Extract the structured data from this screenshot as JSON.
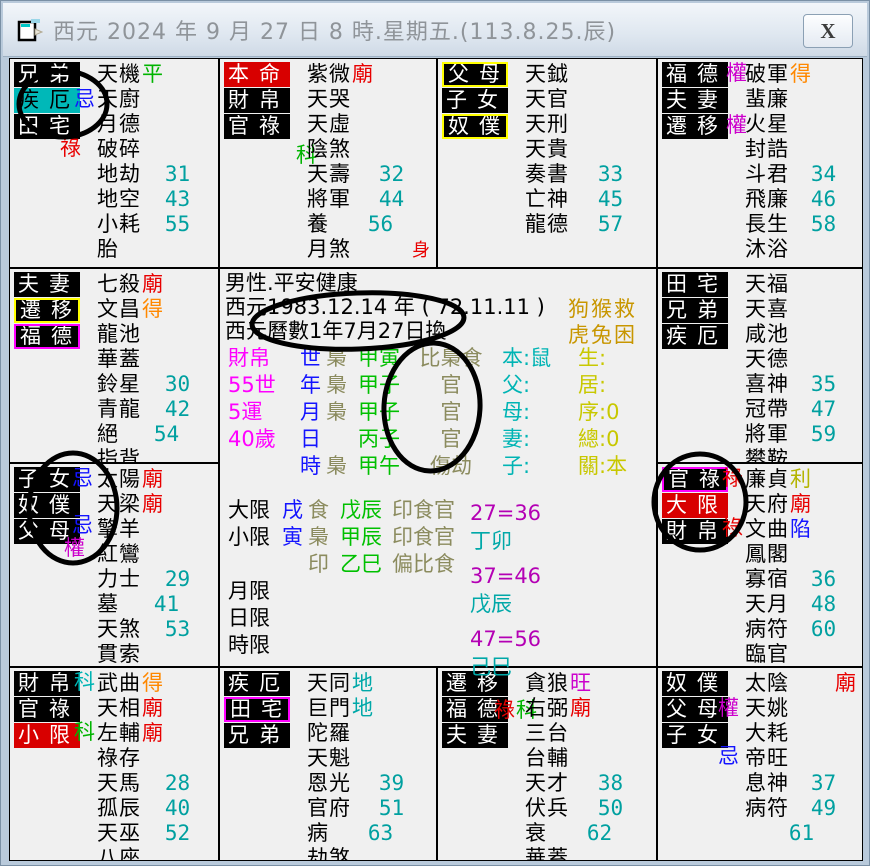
{
  "window": {
    "title": "西元 2024 年 9 月 27 日 8 時.星期五.(113.8.25.辰)",
    "close_label": "X"
  },
  "colors": {
    "transform_lu": "#e80000",
    "transform_quan": "#cc00cc",
    "transform_ke": "#00b400",
    "transform_ke_cyan": "#00b4b4",
    "transform_ji": "#1414ff",
    "bright_miao": "#e80000",
    "bright_de": "#ff8800",
    "bright_ping": "#00b400",
    "bright_wang": "#cc00cc",
    "bright_li": "#b4b400",
    "bright_xian": "#1414ff",
    "bright_di": "#00a8a8",
    "age_number": "#00a0a0",
    "label_black_bg": "#000000",
    "label_red_bg": "#d80000",
    "label_cyan_bg": "#00b8b8",
    "border_yellow": "#ffff00",
    "border_magenta": "#ff00ff"
  },
  "palaces": [
    {
      "branch": "si",
      "labels": [
        {
          "t": "兄弟",
          "s": "k"
        },
        {
          "t": "疾厄",
          "s": "c"
        },
        {
          "t": "田宅",
          "s": "k"
        }
      ],
      "transforms": [
        {
          "t": "忌",
          "c": "#1414ff"
        },
        {
          "t": "祿",
          "c": "#e80000"
        }
      ],
      "stars": [
        {
          "n": "天機",
          "b": "平",
          "bc": "#00b400"
        },
        {
          "n": "天廚"
        },
        {
          "n": "月德"
        },
        {
          "n": "破碎"
        },
        {
          "n": "地劫",
          "a": "31"
        },
        {
          "n": "地空",
          "a": "43"
        },
        {
          "n": "小耗",
          "a": "55"
        },
        {
          "n": "胎"
        }
      ]
    },
    {
      "branch": "wu",
      "labels": [
        {
          "t": "本命",
          "s": "r"
        },
        {
          "t": "財帛",
          "s": "k"
        },
        {
          "t": "官祿",
          "s": "k"
        }
      ],
      "transforms": [
        {
          "t": "科",
          "c": "#00b400"
        }
      ],
      "stars": [
        {
          "n": "紫微",
          "b": "廟",
          "bc": "#e80000"
        },
        {
          "n": "天哭"
        },
        {
          "n": "天虛"
        },
        {
          "n": "陰煞"
        },
        {
          "n": "天壽",
          "a": "32"
        },
        {
          "n": "將軍",
          "a": "44"
        },
        {
          "n": "養",
          "a": "56"
        },
        {
          "n": "月煞",
          "t": "身",
          "tc": "#e80000",
          "tsm": "1"
        }
      ]
    },
    {
      "branch": "wei",
      "labels": [
        {
          "t": "父母",
          "s": "y"
        },
        {
          "t": "子女",
          "s": "k"
        },
        {
          "t": "奴僕",
          "s": "y"
        }
      ],
      "transforms": [],
      "stars": [
        {
          "n": "天鉞"
        },
        {
          "n": "天官"
        },
        {
          "n": "天刑"
        },
        {
          "n": "天貴"
        },
        {
          "n": "奏書",
          "a": "33"
        },
        {
          "n": "亡神",
          "a": "45"
        },
        {
          "n": "龍德",
          "a": "57"
        }
      ]
    },
    {
      "branch": "shen",
      "labels": [
        {
          "t": "福德",
          "s": "k"
        },
        {
          "t": "夫妻",
          "s": "k"
        },
        {
          "t": "遷移",
          "s": "k"
        }
      ],
      "transforms": [
        {
          "t": "權",
          "c": "#cc00cc"
        },
        {
          "t": "權",
          "c": "#cc00cc"
        }
      ],
      "stars": [
        {
          "n": "破軍",
          "b": "得",
          "bc": "#ff8800"
        },
        {
          "n": "蜚廉"
        },
        {
          "n": "火星"
        },
        {
          "n": "封誥"
        },
        {
          "n": "斗君",
          "a": "34"
        },
        {
          "n": "飛廉",
          "a": "46"
        },
        {
          "n": "長生",
          "a": "58"
        },
        {
          "n": "沐浴"
        }
      ]
    },
    {
      "branch": "chen",
      "labels": [
        {
          "t": "夫妻",
          "s": "k"
        },
        {
          "t": "遷移",
          "s": "y"
        },
        {
          "t": "福德",
          "s": "m"
        }
      ],
      "transforms": [],
      "stars": [
        {
          "n": "七殺",
          "b": "廟",
          "bc": "#e80000"
        },
        {
          "n": "文昌",
          "b": "得",
          "bc": "#ff8800"
        },
        {
          "n": "龍池"
        },
        {
          "n": "華蓋"
        },
        {
          "n": "鈴星",
          "a": "30"
        },
        {
          "n": "青龍",
          "a": "42"
        },
        {
          "n": "絕",
          "a": "54"
        },
        {
          "n": "指背"
        }
      ]
    },
    {
      "branch": "you",
      "labels": [
        {
          "t": "田宅",
          "s": "k"
        },
        {
          "t": "兄弟",
          "s": "k"
        },
        {
          "t": "疾厄",
          "s": "k"
        }
      ],
      "transforms": [],
      "stars": [
        {
          "n": "天福"
        },
        {
          "n": "天喜"
        },
        {
          "n": "咸池"
        },
        {
          "n": "天德"
        },
        {
          "n": "喜神",
          "a": "35"
        },
        {
          "n": "冠帶",
          "a": "47"
        },
        {
          "n": "將軍",
          "a": "59"
        },
        {
          "n": "攀鞍"
        }
      ]
    },
    {
      "branch": "mao",
      "labels": [
        {
          "t": "子女",
          "s": "k"
        },
        {
          "t": "奴僕",
          "s": "k"
        },
        {
          "t": "父母",
          "s": "k"
        }
      ],
      "transforms": [
        {
          "t": "忌",
          "c": "#1414ff"
        },
        {
          "t": "忌",
          "c": "#1414ff"
        },
        {
          "t": "權",
          "c": "#cc00cc"
        }
      ],
      "stars": [
        {
          "n": "太陽",
          "b": "廟",
          "bc": "#e80000"
        },
        {
          "n": "天梁",
          "b": "廟",
          "bc": "#e80000"
        },
        {
          "n": "擎羊"
        },
        {
          "n": "紅鸞"
        },
        {
          "n": "力士",
          "a": "29"
        },
        {
          "n": "墓",
          "a": "41"
        },
        {
          "n": "天煞",
          "a": "53"
        },
        {
          "n": "貫索"
        }
      ]
    },
    {
      "branch": "xu",
      "labels": [
        {
          "t": "官祿",
          "s": "m"
        },
        {
          "t": "大限",
          "s": "r"
        },
        {
          "t": "財帛",
          "s": "k"
        }
      ],
      "transforms": [
        {
          "t": "祿",
          "c": "#e80000"
        },
        {
          "t": "祿",
          "c": "#e80000"
        }
      ],
      "stars": [
        {
          "n": "廉貞",
          "b": "利",
          "bc": "#b4b400"
        },
        {
          "n": "天府",
          "b": "廟",
          "bc": "#e80000"
        },
        {
          "n": "文曲",
          "b": "陷",
          "bc": "#1414ff"
        },
        {
          "n": "鳳閣"
        },
        {
          "n": "寡宿",
          "a": "36"
        },
        {
          "n": "天月",
          "a": "48"
        },
        {
          "n": "病符",
          "a": "60"
        },
        {
          "n": "臨官"
        }
      ]
    },
    {
      "branch": "yin",
      "labels": [
        {
          "t": "財帛",
          "s": "k"
        },
        {
          "t": "官祿",
          "s": "k"
        },
        {
          "t": "小限",
          "s": "r"
        }
      ],
      "transforms": [
        {
          "t": "科",
          "c": "#00b4b4"
        },
        {
          "t": "科",
          "c": "#00b400"
        }
      ],
      "stars": [
        {
          "n": "武曲",
          "b": "得",
          "bc": "#ff8800"
        },
        {
          "n": "天相",
          "b": "廟",
          "bc": "#e80000"
        },
        {
          "n": "左輔",
          "b": "廟",
          "bc": "#e80000"
        },
        {
          "n": "祿存"
        },
        {
          "n": "天馬",
          "a": "28"
        },
        {
          "n": "孤辰",
          "a": "40"
        },
        {
          "n": "天巫",
          "a": "52"
        },
        {
          "n": "八座"
        }
      ]
    },
    {
      "branch": "chou",
      "labels": [
        {
          "t": "疾厄",
          "s": "k"
        },
        {
          "t": "田宅",
          "s": "m"
        },
        {
          "t": "兄弟",
          "s": "k"
        }
      ],
      "transforms": [],
      "stars": [
        {
          "n": "天同",
          "b": "地",
          "bc": "#00a8a8"
        },
        {
          "n": "巨門",
          "b": "地",
          "bc": "#00a8a8"
        },
        {
          "n": "陀羅"
        },
        {
          "n": "天魁"
        },
        {
          "n": "恩光",
          "a": "39"
        },
        {
          "n": "官府",
          "a": "51"
        },
        {
          "n": "病",
          "a": "63"
        },
        {
          "n": "劫煞"
        }
      ]
    },
    {
      "branch": "zi",
      "labels": [
        {
          "t": "遷移",
          "s": "k"
        },
        {
          "t": "福德",
          "s": "k"
        },
        {
          "t": "夫妻",
          "s": "k"
        }
      ],
      "transforms": [
        {
          "t": "祿",
          "c": "#e80000"
        },
        {
          "t": "科",
          "c": "#00b400"
        }
      ],
      "stars": [
        {
          "n": "貪狼",
          "b": "旺",
          "bc": "#cc00cc"
        },
        {
          "n": "右弼",
          "b": "廟",
          "bc": "#e80000"
        },
        {
          "n": "三台"
        },
        {
          "n": "台輔"
        },
        {
          "n": "天才",
          "a": "38"
        },
        {
          "n": "伏兵",
          "a": "50"
        },
        {
          "n": "衰",
          "a": "62"
        },
        {
          "n": "華蓋"
        }
      ]
    },
    {
      "branch": "hai",
      "labels": [
        {
          "t": "奴僕",
          "s": "k"
        },
        {
          "t": "父母",
          "s": "k"
        },
        {
          "t": "子女",
          "s": "k"
        }
      ],
      "transforms": [
        {
          "t": "權",
          "c": "#cc00cc"
        },
        {
          "t": "忌",
          "c": "#1414ff"
        }
      ],
      "stars": [
        {
          "n": "太陰",
          "t": "廟",
          "tc": "#e80000"
        },
        {
          "n": "天姚"
        },
        {
          "n": "大耗"
        },
        {
          "n": "帝旺"
        },
        {
          "n": "息神",
          "a": "37"
        },
        {
          "n": "病符",
          "a": "49"
        },
        {
          "n": "",
          "a": "61"
        }
      ]
    }
  ],
  "center": {
    "line1": "男性.平安健康",
    "line2": "西元1983.12.14 年 ( 72.11.11 )",
    "line3": "西元曆數1年7月27日換",
    "zodiac_note": {
      "line1": "狗猴救",
      "line2": "虎兔困"
    },
    "pillars": {
      "rows": [
        {
          "label": "財帛",
          "key": "世",
          "god": "梟",
          "pillar": "甲寅",
          "gods2": "比梟食",
          "rel": "本:鼠",
          "info": "生:"
        },
        {
          "label": "55世",
          "key": "年",
          "god": "梟",
          "pillar": "甲子",
          "gods2": "官",
          "rel": "父:",
          "info": "居:"
        },
        {
          "label": "5運",
          "key": "月",
          "god": "梟",
          "pillar": "甲子",
          "gods2": "官",
          "rel": "母:",
          "info": "序:0"
        },
        {
          "label": "40歲",
          "key": "日",
          "god": "",
          "pillar": "丙子",
          "gods2": "官",
          "rel": "妻:",
          "info": "總:0"
        },
        {
          "label": "",
          "key": "時",
          "god": "梟",
          "pillar": "甲午",
          "gods2": "傷劫",
          "rel": "子:",
          "info": "關:本"
        }
      ]
    },
    "limits": {
      "rows": [
        {
          "label": "大限",
          "branch": "戌",
          "god": "食",
          "pillar": "戊辰",
          "gods2": "印食官"
        },
        {
          "label": "小限",
          "branch": "寅",
          "god": "梟",
          "pillar": "甲辰",
          "gods2": "印食官"
        },
        {
          "label": "",
          "branch": "",
          "god": "印",
          "pillar": "乙巳",
          "gods2": "偏比食"
        },
        {
          "label": "月限",
          "branch": "",
          "god": "",
          "pillar": "",
          "gods2": ""
        },
        {
          "label": "日限",
          "branch": "",
          "god": "",
          "pillar": "",
          "gods2": ""
        },
        {
          "label": "時限",
          "branch": "",
          "god": "",
          "pillar": "",
          "gods2": ""
        }
      ],
      "right": [
        "27=36",
        "丁卯",
        "37=46",
        "戊辰",
        "47=56",
        "己巳"
      ]
    }
  },
  "annotations": [
    {
      "cx": 62,
      "cy": 103,
      "rx": 44,
      "ry": 33
    },
    {
      "cx": 357,
      "cy": 320,
      "rx": 106,
      "ry": 28
    },
    {
      "cx": 431,
      "cy": 406,
      "rx": 48,
      "ry": 64
    },
    {
      "cx": 72,
      "cy": 507,
      "rx": 44,
      "ry": 55
    },
    {
      "cx": 699,
      "cy": 501,
      "rx": 46,
      "ry": 48
    }
  ]
}
